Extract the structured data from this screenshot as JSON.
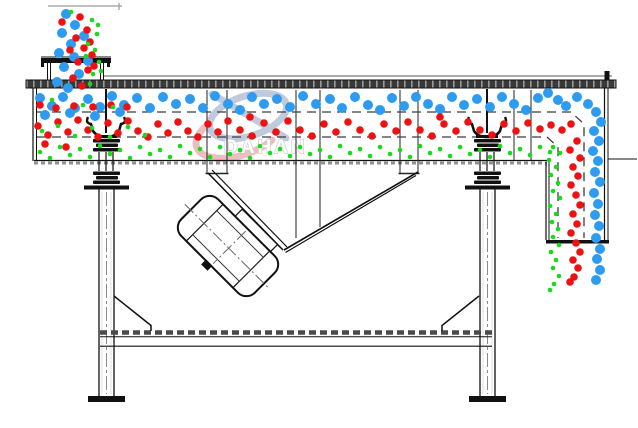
{
  "diagram": {
    "title": "linear-vibrating-screen-cross-section",
    "watermark": {
      "brand": "DAHAN",
      "registered_mark": "®"
    },
    "colors": {
      "coarse_blue": "#2D9BF0",
      "medium_red": "#EE1111",
      "fine_green": "#16DB16",
      "line": "#111111",
      "watermark_blue": "#b9c6da",
      "watermark_pink": "#ecb8ba",
      "watermark_text": "#c8c8c8"
    },
    "particles": {
      "coarse_blue": {
        "radius": 5,
        "points": [
          [
            66,
            14
          ],
          [
            75,
            25
          ],
          [
            62,
            33
          ],
          [
            71,
            44
          ],
          [
            59,
            53
          ],
          [
            74,
            57
          ],
          [
            64,
            67
          ],
          [
            79,
            74
          ],
          [
            57,
            82
          ],
          [
            68,
            88
          ],
          [
            84,
            36
          ],
          [
            88,
            61
          ],
          [
            45,
            115
          ],
          [
            70,
            113
          ],
          [
            95,
            116
          ],
          [
            120,
            112
          ],
          [
            40,
            98
          ],
          [
            52,
            106
          ],
          [
            63,
            97
          ],
          [
            75,
            108
          ],
          [
            88,
            99
          ],
          [
            100,
            107
          ],
          [
            112,
            96
          ],
          [
            124,
            105
          ],
          [
            137,
            98
          ],
          [
            150,
            108
          ],
          [
            163,
            97
          ],
          [
            176,
            104
          ],
          [
            190,
            99
          ],
          [
            203,
            108
          ],
          [
            215,
            96
          ],
          [
            228,
            104
          ],
          [
            240,
            110
          ],
          [
            252,
            97
          ],
          [
            264,
            104
          ],
          [
            277,
            99
          ],
          [
            290,
            107
          ],
          [
            303,
            96
          ],
          [
            316,
            104
          ],
          [
            330,
            99
          ],
          [
            342,
            108
          ],
          [
            355,
            97
          ],
          [
            368,
            105
          ],
          [
            380,
            110
          ],
          [
            392,
            98
          ],
          [
            404,
            106
          ],
          [
            416,
            97
          ],
          [
            428,
            104
          ],
          [
            440,
            109
          ],
          [
            452,
            97
          ],
          [
            464,
            105
          ],
          [
            477,
            99
          ],
          [
            490,
            107
          ],
          [
            502,
            97
          ],
          [
            514,
            104
          ],
          [
            526,
            110
          ],
          [
            538,
            98
          ],
          [
            548,
            93
          ],
          [
            558,
            100
          ],
          [
            566,
            106
          ],
          [
            577,
            97
          ],
          [
            588,
            104
          ],
          [
            596,
            112
          ],
          [
            601,
            122
          ],
          [
            594,
            131
          ],
          [
            599,
            141
          ],
          [
            593,
            151
          ],
          [
            598,
            161
          ],
          [
            595,
            172
          ],
          [
            600,
            182
          ],
          [
            594,
            193
          ],
          [
            598,
            204
          ],
          [
            595,
            215
          ],
          [
            599,
            226
          ],
          [
            596,
            238
          ],
          [
            600,
            249
          ],
          [
            597,
            259
          ],
          [
            600,
            270
          ],
          [
            596,
            280
          ]
        ]
      },
      "medium_red": {
        "radius": 3.8,
        "points": [
          [
            80,
            17
          ],
          [
            87,
            30
          ],
          [
            76,
            38
          ],
          [
            84,
            48
          ],
          [
            92,
            55
          ],
          [
            70,
            50
          ],
          [
            78,
            62
          ],
          [
            88,
            70
          ],
          [
            73,
            78
          ],
          [
            62,
            22
          ],
          [
            90,
            42
          ],
          [
            82,
            86
          ],
          [
            94,
            66
          ],
          [
            40,
            105
          ],
          [
            56,
            108
          ],
          [
            74,
            106
          ],
          [
            93,
            107
          ],
          [
            111,
            105
          ],
          [
            127,
            107
          ],
          [
            250,
            117
          ],
          [
            440,
            117
          ],
          [
            38,
            126
          ],
          [
            48,
            135
          ],
          [
            58,
            122
          ],
          [
            68,
            132
          ],
          [
            78,
            120
          ],
          [
            88,
            130
          ],
          [
            98,
            137
          ],
          [
            108,
            123
          ],
          [
            118,
            133
          ],
          [
            128,
            121
          ],
          [
            138,
            131
          ],
          [
            148,
            137
          ],
          [
            158,
            124
          ],
          [
            168,
            133
          ],
          [
            178,
            122
          ],
          [
            188,
            131
          ],
          [
            198,
            137
          ],
          [
            208,
            124
          ],
          [
            218,
            132
          ],
          [
            228,
            121
          ],
          [
            240,
            130
          ],
          [
            252,
            136
          ],
          [
            264,
            123
          ],
          [
            276,
            132
          ],
          [
            288,
            121
          ],
          [
            300,
            130
          ],
          [
            312,
            136
          ],
          [
            324,
            124
          ],
          [
            336,
            132
          ],
          [
            348,
            122
          ],
          [
            360,
            130
          ],
          [
            372,
            136
          ],
          [
            384,
            124
          ],
          [
            396,
            131
          ],
          [
            408,
            122
          ],
          [
            420,
            130
          ],
          [
            432,
            136
          ],
          [
            444,
            124
          ],
          [
            456,
            131
          ],
          [
            468,
            122
          ],
          [
            480,
            130
          ],
          [
            492,
            135
          ],
          [
            504,
            124
          ],
          [
            516,
            131
          ],
          [
            528,
            123
          ],
          [
            540,
            129
          ],
          [
            551,
            125
          ],
          [
            562,
            130
          ],
          [
            571,
            124
          ],
          [
            45,
            144
          ],
          [
            66,
            147
          ],
          [
            577,
            141
          ],
          [
            570,
            150
          ],
          [
            580,
            158
          ],
          [
            573,
            167
          ],
          [
            578,
            176
          ],
          [
            571,
            185
          ],
          [
            576,
            195
          ],
          [
            580,
            205
          ],
          [
            573,
            214
          ],
          [
            577,
            224
          ],
          [
            571,
            233
          ],
          [
            576,
            243
          ],
          [
            580,
            252
          ],
          [
            573,
            260
          ],
          [
            578,
            268
          ],
          [
            574,
            277
          ],
          [
            570,
            282
          ]
        ]
      },
      "fine_green": {
        "radius": 2.3,
        "points": [
          [
            92,
            20
          ],
          [
            97,
            34
          ],
          [
            88,
            44
          ],
          [
            95,
            50
          ],
          [
            99,
            62
          ],
          [
            86,
            56
          ],
          [
            93,
            74
          ],
          [
            101,
            71
          ],
          [
            90,
            84
          ],
          [
            71,
            12
          ],
          [
            98,
            25
          ],
          [
            52,
            100
          ],
          [
            83,
            105
          ],
          [
            113,
            107
          ],
          [
            42,
            131
          ],
          [
            58,
            126
          ],
          [
            75,
            136
          ],
          [
            92,
            128
          ],
          [
            110,
            137
          ],
          [
            128,
            127
          ],
          [
            145,
            135
          ],
          [
            40,
            152
          ],
          [
            50,
            158
          ],
          [
            60,
            147
          ],
          [
            70,
            155
          ],
          [
            80,
            149
          ],
          [
            90,
            157
          ],
          [
            100,
            146
          ],
          [
            110,
            154
          ],
          [
            120,
            150
          ],
          [
            130,
            158
          ],
          [
            140,
            147
          ],
          [
            150,
            154
          ],
          [
            160,
            150
          ],
          [
            170,
            157
          ],
          [
            180,
            146
          ],
          [
            190,
            153
          ],
          [
            200,
            149
          ],
          [
            210,
            157
          ],
          [
            220,
            147
          ],
          [
            230,
            154
          ],
          [
            240,
            150
          ],
          [
            250,
            158
          ],
          [
            260,
            146
          ],
          [
            270,
            153
          ],
          [
            280,
            149
          ],
          [
            290,
            156
          ],
          [
            300,
            147
          ],
          [
            310,
            154
          ],
          [
            320,
            150
          ],
          [
            330,
            157
          ],
          [
            340,
            146
          ],
          [
            350,
            153
          ],
          [
            360,
            149
          ],
          [
            370,
            156
          ],
          [
            380,
            147
          ],
          [
            390,
            154
          ],
          [
            400,
            150
          ],
          [
            410,
            157
          ],
          [
            420,
            146
          ],
          [
            430,
            153
          ],
          [
            440,
            149
          ],
          [
            450,
            156
          ],
          [
            460,
            147
          ],
          [
            470,
            154
          ],
          [
            480,
            150
          ],
          [
            490,
            157
          ],
          [
            500,
            146
          ],
          [
            510,
            153
          ],
          [
            520,
            149
          ],
          [
            530,
            155
          ],
          [
            540,
            147
          ],
          [
            550,
            152
          ],
          [
            553,
            147
          ],
          [
            560,
            153
          ],
          [
            549,
            160
          ],
          [
            556,
            167
          ],
          [
            551,
            175
          ],
          [
            558,
            183
          ],
          [
            553,
            191
          ],
          [
            560,
            198
          ],
          [
            550,
            206
          ],
          [
            556,
            214
          ],
          [
            552,
            222
          ],
          [
            558,
            229
          ],
          [
            553,
            237
          ],
          [
            559,
            245
          ],
          [
            551,
            252
          ],
          [
            556,
            260
          ],
          [
            553,
            268
          ],
          [
            559,
            276
          ],
          [
            554,
            284
          ],
          [
            550,
            290
          ]
        ]
      }
    }
  }
}
